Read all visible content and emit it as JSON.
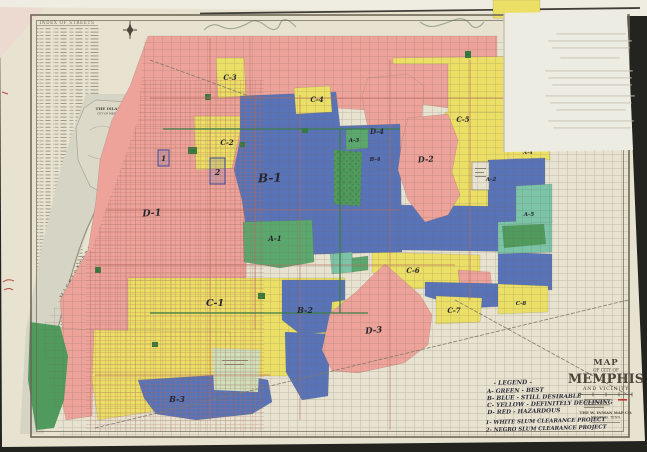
{
  "map_title_block": {
    "line_map": "MAP",
    "line_of": "OF CITY OF",
    "line_city": "MEMPHIS",
    "line_vicinity": "AND VICINITY",
    "publisher": "THE W. INMAN MAP CO.",
    "publisher_city": "MEMPHIS, TENN."
  },
  "legend": {
    "heading": "- LEGEND -",
    "items": [
      "A- GREEN - BEST",
      "B- BLUE - STILL DESIRABLE",
      "C- YELLOW - DEFINITELY DECLINING",
      "D- RED - HAZARDOUS"
    ],
    "notes": [
      "1- WHITE SLUM CLEARANCE PROJECT",
      "2- NEGRO SLUM CLEARANCE PROJECT"
    ]
  },
  "map_labels": {
    "street_index_heading": "INDEX OF STREETS",
    "island": "THE ISLAND",
    "island_sub": "CITY OF MEMPHIS",
    "river": "MISSISSIPPI RIVER"
  },
  "zone_labels": [
    "D-1",
    "C-2",
    "C-3",
    "B-1",
    "C-4",
    "D-4",
    "A-3",
    "C-5",
    "D-2",
    "B-5",
    "A-4",
    "A-2",
    "A-1",
    "C-1",
    "B-2",
    "C-6",
    "C-7",
    "D-3",
    "B-3",
    "B-4",
    "A-5",
    "C-8"
  ],
  "slum_clearance_markers": [
    "1",
    "2"
  ],
  "palette": {
    "grade_a_green": "#5aa86d",
    "grade_b_blue": "#5873b7",
    "grade_c_yellow": "#ecdf66",
    "grade_d_red": "#eda39a",
    "paper": "#e8e3d0",
    "river_gray": "#d6d4c5",
    "background": "#23231f"
  }
}
